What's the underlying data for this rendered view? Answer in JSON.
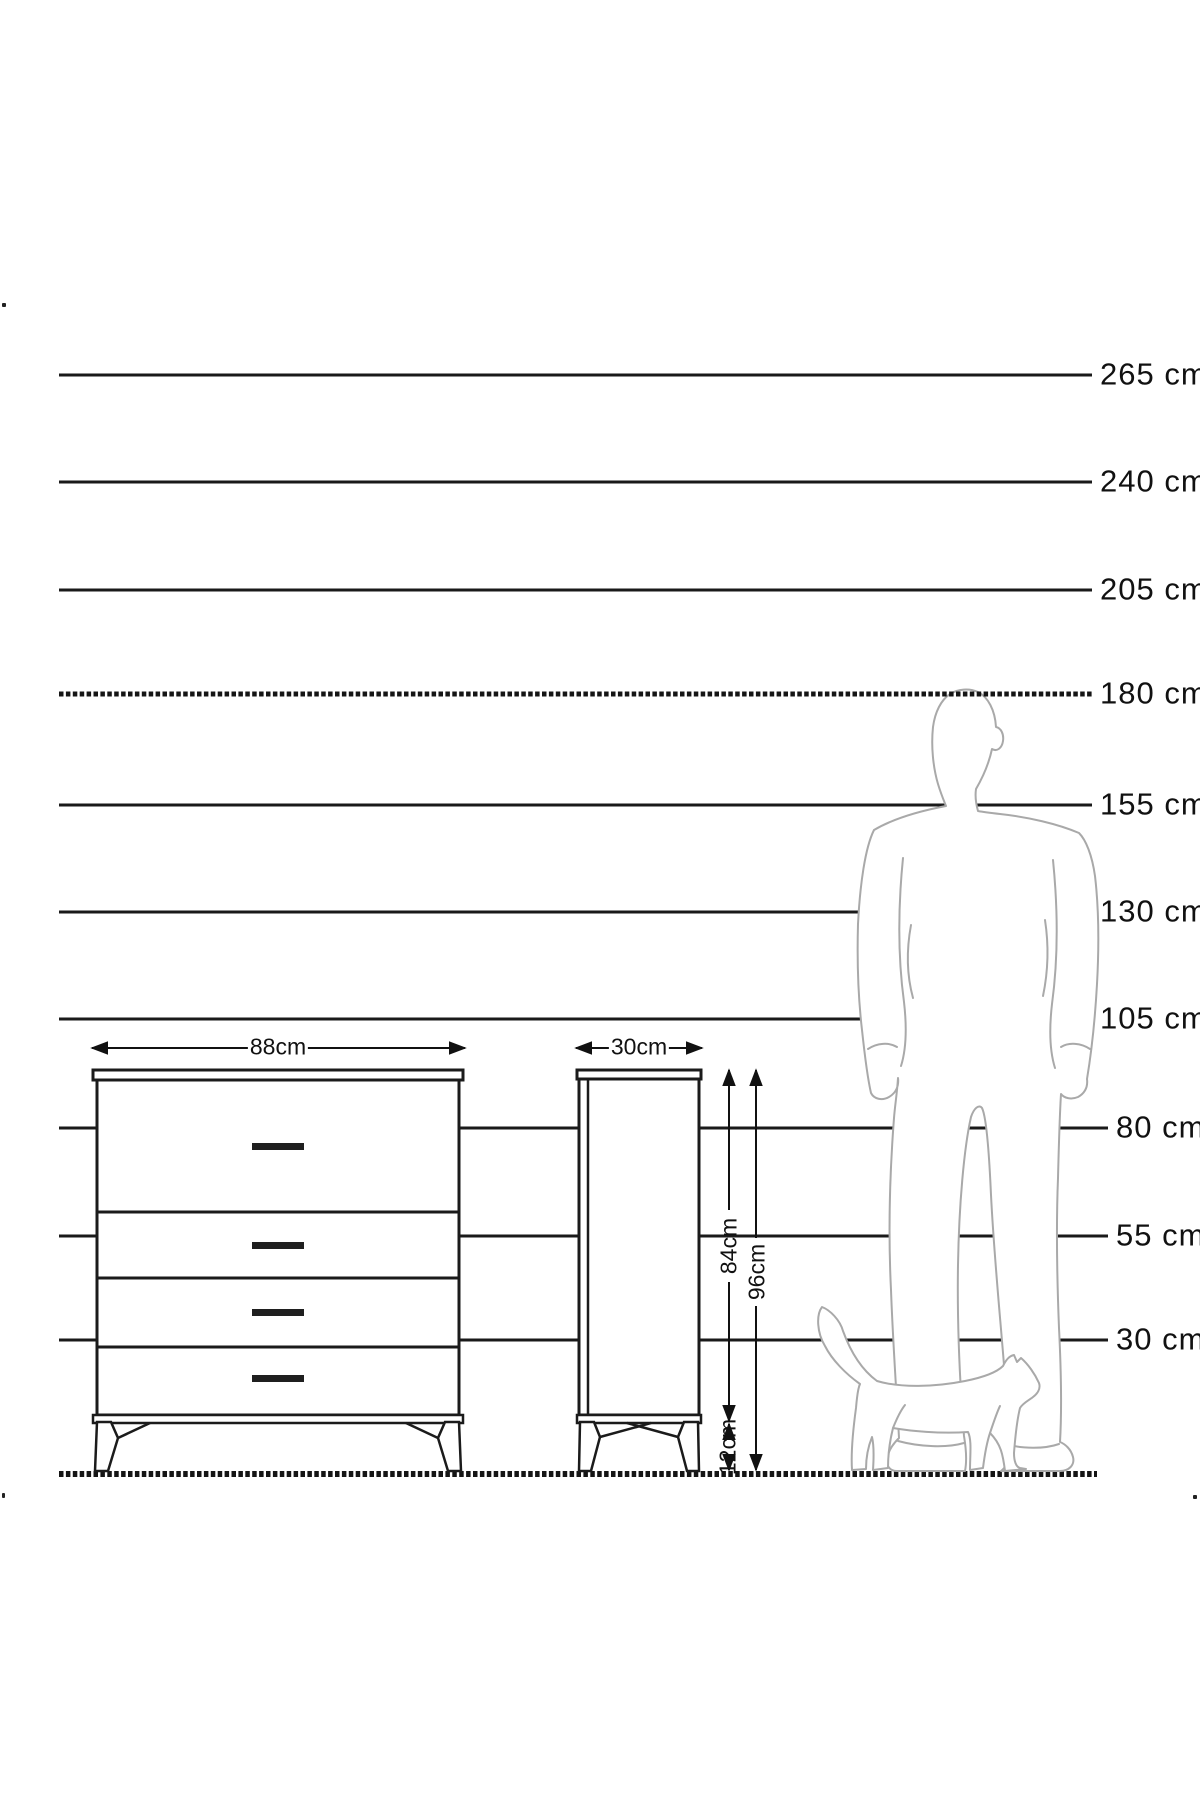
{
  "diagram": {
    "title_hint": "furniture height comparison drawing",
    "unit": "cm",
    "height_scale_labels": [
      "265 cm",
      "240 cm",
      "205 cm",
      "180 cm",
      "155 cm",
      "130 cm",
      "105 cm",
      "80 cm",
      "55 cm",
      "30 cm"
    ],
    "dimension_labels": {
      "dresser_width": "88cm",
      "cabinet_side_depth": "30cm",
      "body_height": "84cm",
      "total_height": "96cm",
      "leg_height": "12cm"
    },
    "furniture": {
      "front_view_drawer_count": 4,
      "views": [
        "dresser-front-view",
        "dresser-side-view"
      ]
    },
    "figures": [
      "man-silhouette",
      "cat-silhouette"
    ],
    "colors": {
      "background": "#ffffff",
      "line": "#1a1a1a",
      "silhouette_stroke": "#a9a9a9",
      "handle_fill": "#1f1f1f"
    }
  }
}
